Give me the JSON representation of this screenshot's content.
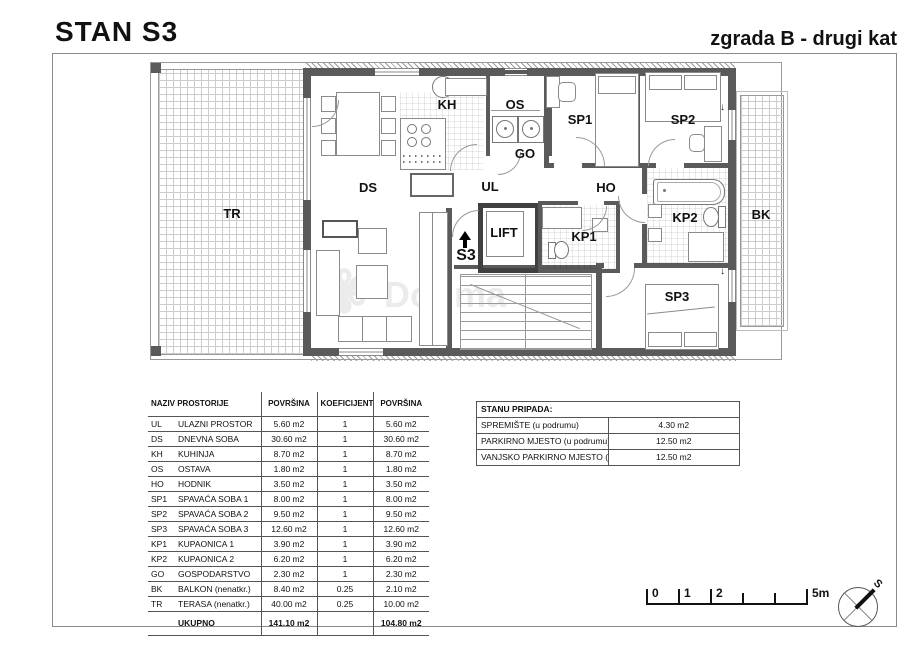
{
  "header": {
    "title_left": "STAN S3",
    "title_right": "zgrada B - drugi kat"
  },
  "plan": {
    "labels": {
      "tr": "TR",
      "ds": "DS",
      "kh": "KH",
      "os": "OS",
      "go": "GO",
      "ul": "UL",
      "ho": "HO",
      "sp1": "SP1",
      "sp2": "SP2",
      "sp3": "SP3",
      "kp1": "KP1",
      "kp2": "KP2",
      "bk": "BK",
      "lift": "LIFT",
      "unit": "S3"
    },
    "balcony_door_arrow": "↓"
  },
  "area_table": {
    "headers": {
      "name": "NAZIV PROSTORIJE",
      "area": "POVRŠINA",
      "coef": "KOEFICIJENT",
      "area2": "POVRŠINA"
    },
    "rows": [
      {
        "code": "UL",
        "name": "ULAZNI PROSTOR",
        "area": "5.60 m2",
        "coef": "1",
        "area2": "5.60 m2"
      },
      {
        "code": "DS",
        "name": "DNEVNA SOBA",
        "area": "30.60 m2",
        "coef": "1",
        "area2": "30.60 m2"
      },
      {
        "code": "KH",
        "name": "KUHINJA",
        "area": "8.70 m2",
        "coef": "1",
        "area2": "8.70 m2"
      },
      {
        "code": "OS",
        "name": "OSTAVA",
        "area": "1.80 m2",
        "coef": "1",
        "area2": "1.80 m2"
      },
      {
        "code": "HO",
        "name": "HODNIK",
        "area": "3.50 m2",
        "coef": "1",
        "area2": "3.50 m2"
      },
      {
        "code": "SP1",
        "name": "SPAVAĆA SOBA 1",
        "area": "8.00 m2",
        "coef": "1",
        "area2": "8.00 m2"
      },
      {
        "code": "SP2",
        "name": "SPAVAĆA SOBA 2",
        "area": "9.50 m2",
        "coef": "1",
        "area2": "9.50 m2"
      },
      {
        "code": "SP3",
        "name": "SPAVAĆA SOBA 3",
        "area": "12.60 m2",
        "coef": "1",
        "area2": "12.60 m2"
      },
      {
        "code": "KP1",
        "name": "KUPAONICA 1",
        "area": "3.90 m2",
        "coef": "1",
        "area2": "3.90 m2"
      },
      {
        "code": "KP2",
        "name": "KUPAONICA 2",
        "area": "6.20 m2",
        "coef": "1",
        "area2": "6.20 m2"
      },
      {
        "code": "GO",
        "name": "GOSPODARSTVO",
        "area": "2.30 m2",
        "coef": "1",
        "area2": "2.30 m2"
      },
      {
        "code": "BK",
        "name": "BALKON (nenatkr.)",
        "area": "8.40 m2",
        "coef": "0.25",
        "area2": "2.10 m2"
      },
      {
        "code": "TR",
        "name": "TERASA (nenatkr.)",
        "area": "40.00 m2",
        "coef": "0.25",
        "area2": "10.00 m2"
      }
    ],
    "total": {
      "label": "UKUPNO",
      "area": "141.10 m2",
      "area2": "104.80 m2"
    }
  },
  "belongs_table": {
    "title": "STANU PRIPADA:",
    "rows": [
      {
        "name": "SPREMIŠTE (u podrumu)",
        "value": "4.30 m2"
      },
      {
        "name": "PARKIRNO MJESTO (u podrumu)",
        "value": "12.50 m2"
      },
      {
        "name": "VANJSKO PARKIRNO MJESTO (u prizemlju ili podrumu)",
        "value": "12.50 m2"
      }
    ]
  },
  "scale_bar": {
    "labels": [
      "0",
      "1",
      "2",
      "5m"
    ]
  },
  "compass": {
    "label": "S"
  },
  "watermark": {
    "text": "Dogma"
  }
}
